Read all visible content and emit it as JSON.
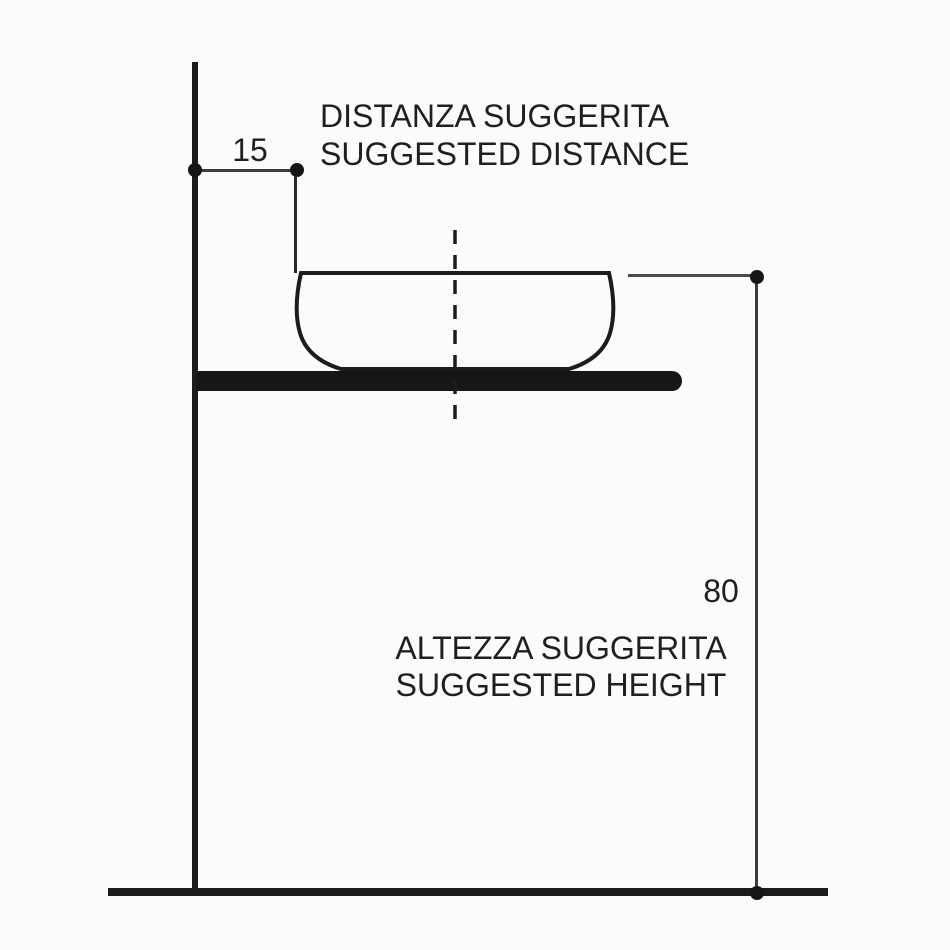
{
  "diagram": {
    "type": "technical-installation-drawing",
    "subject": "countertop washbasin suggested mounting dimensions",
    "distance_label": {
      "line1": "DISTANZA SUGGERITA",
      "line2": "SUGGESTED DISTANCE"
    },
    "height_label": {
      "line1": "ALTEZZA SUGGERITA",
      "line2": "SUGGESTED HEIGHT"
    },
    "dimensions": {
      "suggested_distance_value": "15",
      "suggested_height_value": "80"
    },
    "colors": {
      "background": "#fbfbf9",
      "drawing_line": "#1c1c1c",
      "dimension_line": "#3d3d3d",
      "text": "#1f1f1f"
    }
  }
}
